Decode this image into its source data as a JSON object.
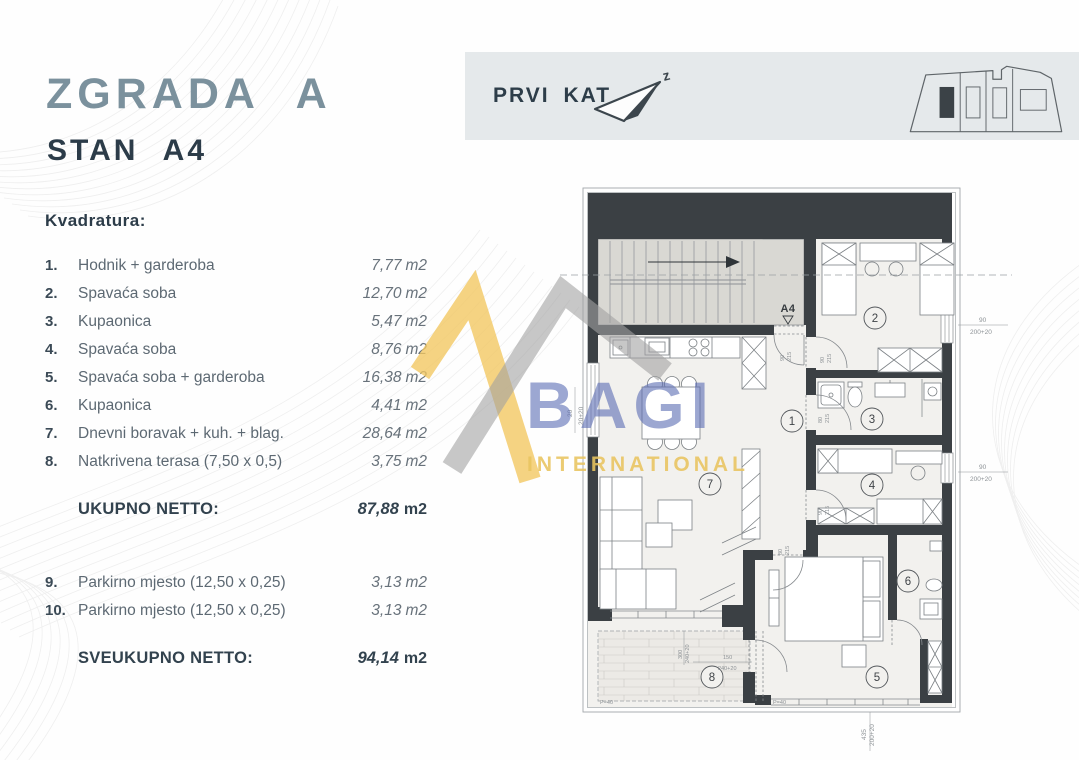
{
  "titles": {
    "building": "ZGRADA A",
    "unit": "STAN A4",
    "section": "Kvadratura:"
  },
  "header": {
    "floor": "PRVI KAT",
    "compass_letter": "z"
  },
  "rooms": [
    {
      "num": "1.",
      "label": "Hodnik + garderoba",
      "value": "7,77",
      "unit": "m2"
    },
    {
      "num": "2.",
      "label": "Spavaća soba",
      "value": "12,70",
      "unit": "m2"
    },
    {
      "num": "3.",
      "label": "Kupaonica",
      "value": "5,47",
      "unit": "m2"
    },
    {
      "num": "4.",
      "label": "Spavaća soba",
      "value": "8,76",
      "unit": "m2"
    },
    {
      "num": "5.",
      "label": "Spavaća soba + garderoba",
      "value": "16,38",
      "unit": "m2"
    },
    {
      "num": "6.",
      "label": "Kupaonica",
      "value": "4,41",
      "unit": "m2"
    },
    {
      "num": "7.",
      "label": "Dnevni boravak + kuh. + blag.",
      "value": "28,64",
      "unit": "m2"
    },
    {
      "num": "8.",
      "label": "Natkrivena terasa (7,50 x 0,5)",
      "value": "3,75",
      "unit": "m2"
    }
  ],
  "parking": [
    {
      "num": "9.",
      "label": "Parkirno mjesto (12,50 x 0,25)",
      "value": "3,13",
      "unit": "m2"
    },
    {
      "num": "10.",
      "label": "Parkirno mjesto (12,50 x 0,25)",
      "value": "3,13",
      "unit": "m2"
    }
  ],
  "totals": {
    "net_label": "UKUPNO NETTO:",
    "net_value": "87,88",
    "net_unit": "m2",
    "grand_label": "SVEUKUPNO NETTO:",
    "grand_value": "94,14",
    "grand_unit": "m2"
  },
  "watermark": {
    "name": "BAGI",
    "subtitle": "INTERNATIONAL",
    "roof_yellow": "#f2c75f",
    "roof_gray": "#a2a2a2",
    "name_blue": "#5b6db4"
  },
  "plan": {
    "unit_label": "A4",
    "room_numbers": [
      "1",
      "2",
      "3",
      "4",
      "5",
      "6",
      "7",
      "8"
    ],
    "dims": {
      "rt_a": "90",
      "rt_b": "200+20",
      "rm_a": "90",
      "rm_b": "200+20",
      "bot_a": "435",
      "bot_b": "200+20",
      "left_a": "20",
      "left_b": "20+20",
      "tv_a": "300",
      "tv_b": "240+20",
      "th_a": "150",
      "th_b": "240+20",
      "p1": "P=40",
      "p2": "P=40"
    },
    "doors": [
      {
        "a": "90",
        "b": "215"
      },
      {
        "a": "90",
        "b": "215"
      },
      {
        "a": "80",
        "b": "215"
      },
      {
        "a": "90",
        "b": "215"
      },
      {
        "a": "80",
        "b": "215"
      }
    ]
  }
}
